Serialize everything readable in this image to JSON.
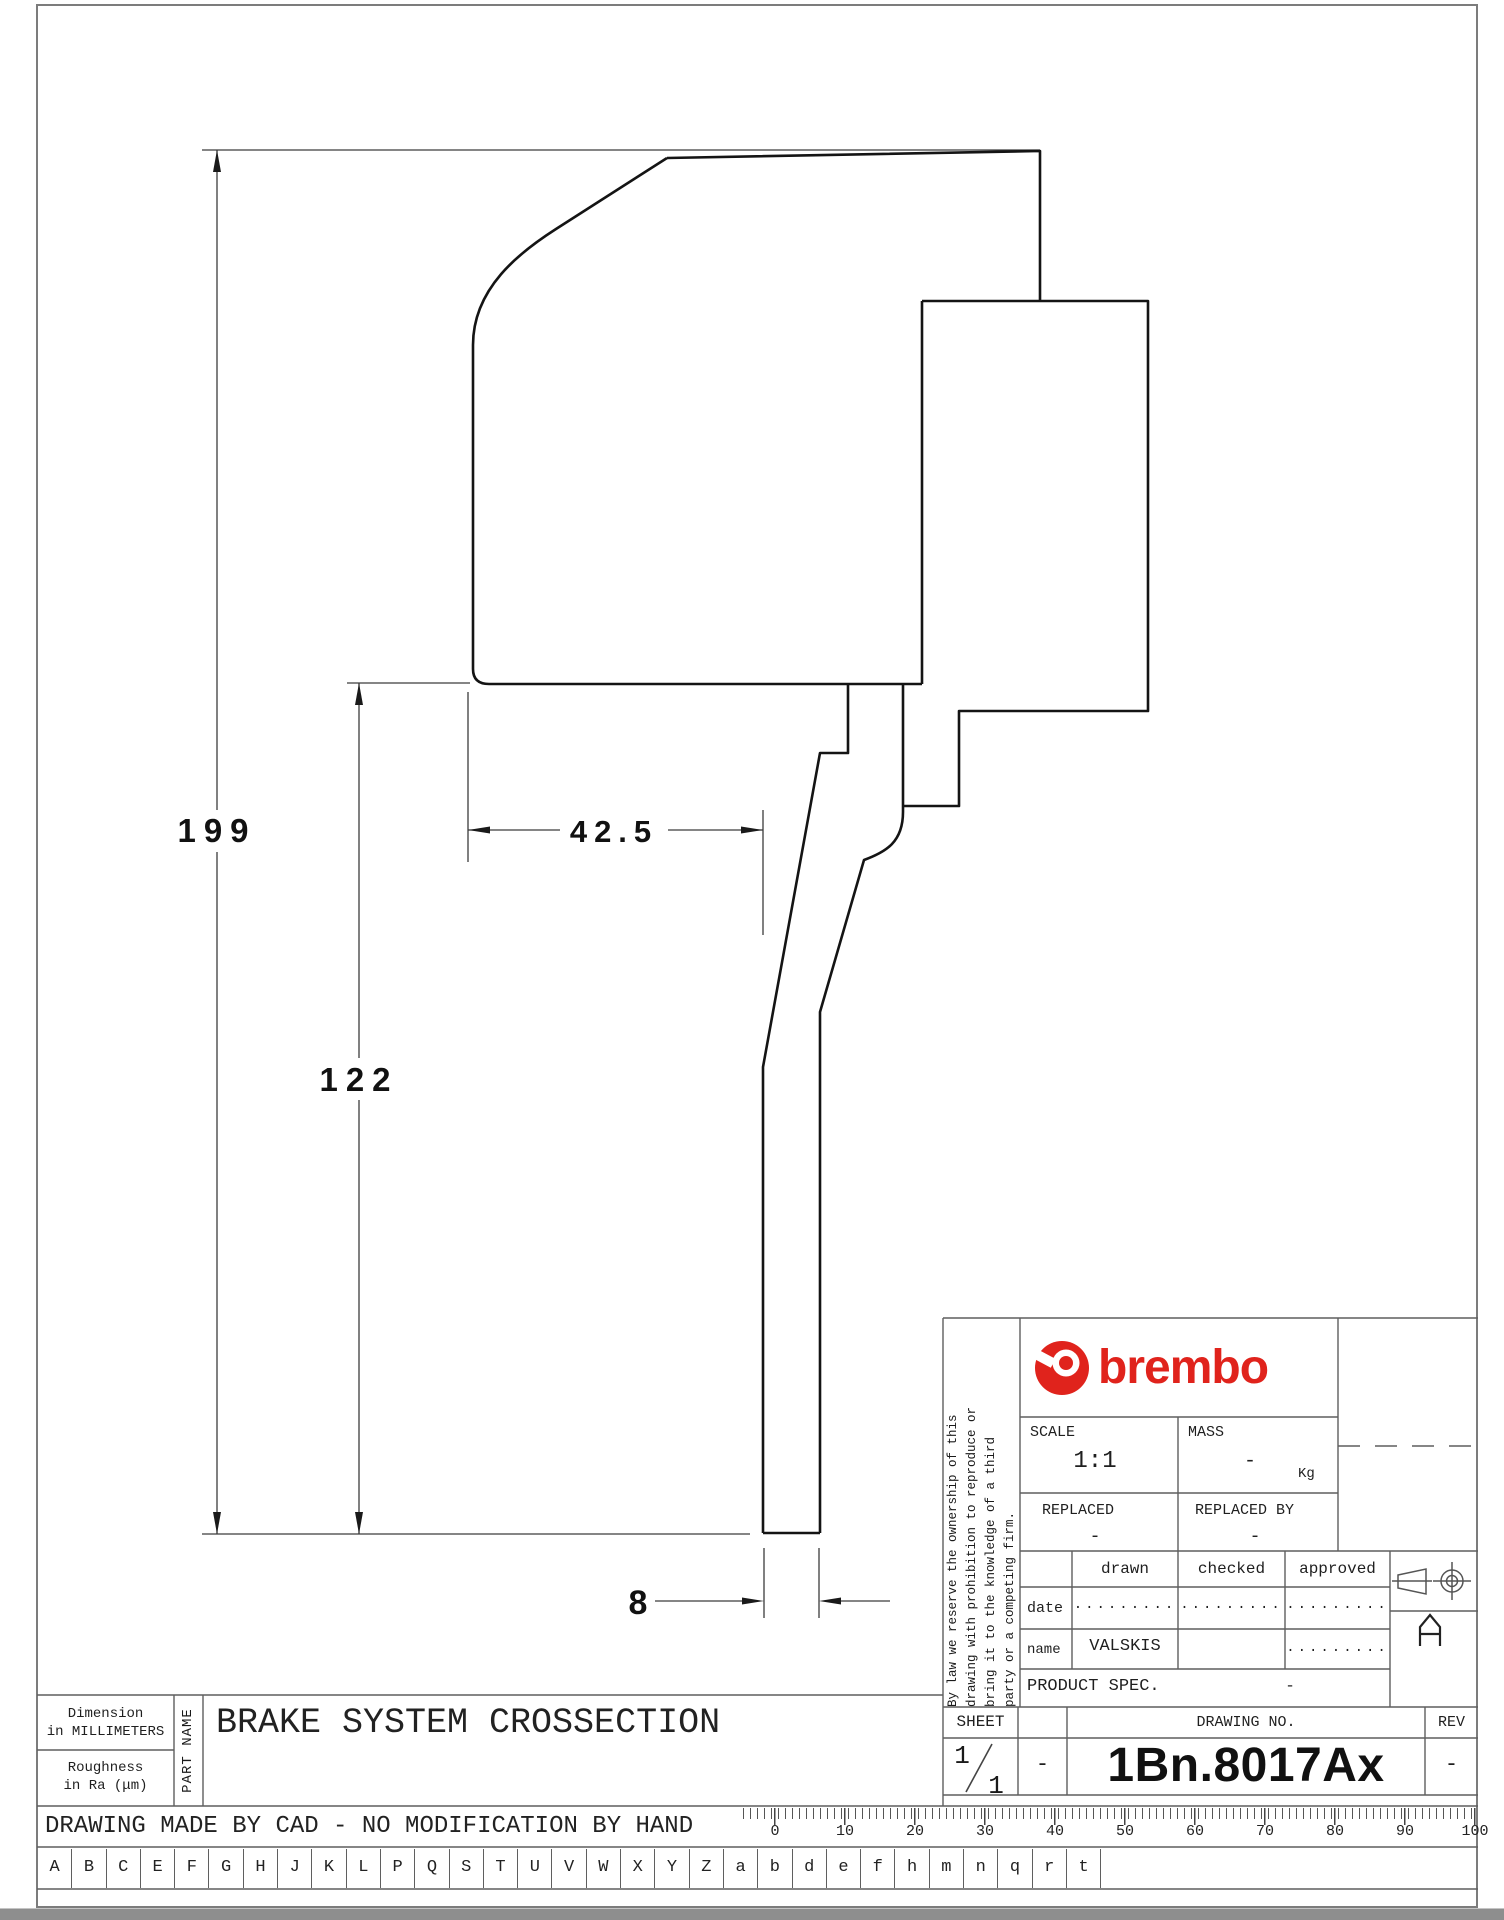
{
  "colors": {
    "brand_red": "#e0231c",
    "shape_line": "#141414",
    "grid_line": "#5f5f5f"
  },
  "drawing": {
    "d199": "199",
    "d122": "122",
    "d42_5": "42.5",
    "d8": "8"
  },
  "title_block": {
    "brand": "brembo",
    "scale_label": "SCALE",
    "scale_value": "1:1",
    "mass_label": "MASS",
    "mass_value": "-",
    "mass_unit": "Kg",
    "replaced_label": "REPLACED",
    "replaced_value": "-",
    "replaced_by_label": "REPLACED BY",
    "replaced_by_value": "-",
    "col_drawn": "drawn",
    "col_checked": "checked",
    "col_approved": "approved",
    "row_date": "date",
    "row_name": "name",
    "date_drawn": ".........",
    "date_checked": ".........",
    "date_approved": ".........",
    "name_drawn": "VALSKIS",
    "name_approved": ".........",
    "product_spec_label": "PRODUCT SPEC.",
    "product_spec_value": "-",
    "sheet_label": "SHEET",
    "drawing_no_label": "DRAWING NO.",
    "rev_label": "REV",
    "sheet_num": "1",
    "sheet_denom": "1",
    "sheet_dash": "-",
    "drawing_no": "1Bn.8017Ax",
    "rev_value": "-",
    "format_letter_name": "A",
    "disclaimer_lines": [
      "By law we reserve the ownership of this",
      "drawing with prohibition to reproduce or",
      "bring it to the knowledge of a third",
      "party or a competing firm."
    ]
  },
  "footer": {
    "dimension_note_line1": "Dimension",
    "dimension_note_line2": "in MILLIMETERS",
    "roughness_line1": "Roughness",
    "roughness_line2": "in Ra (μm)",
    "part_name_label": "PART NAME",
    "part_name": "BRAKE SYSTEM CROSSECTION",
    "cad_note": "DRAWING MADE BY CAD - NO MODIFICATION BY HAND",
    "letters": [
      "A",
      "B",
      "C",
      "E",
      "F",
      "G",
      "H",
      "J",
      "K",
      "L",
      "P",
      "Q",
      "S",
      "T",
      "U",
      "V",
      "W",
      "X",
      "Y",
      "Z",
      "a",
      "b",
      "d",
      "e",
      "f",
      "h",
      "m",
      "n",
      "q",
      "r",
      "t"
    ],
    "ruler_numbers": [
      "0",
      "10",
      "20",
      "30",
      "40",
      "50",
      "60",
      "70",
      "80",
      "90",
      "100"
    ]
  }
}
